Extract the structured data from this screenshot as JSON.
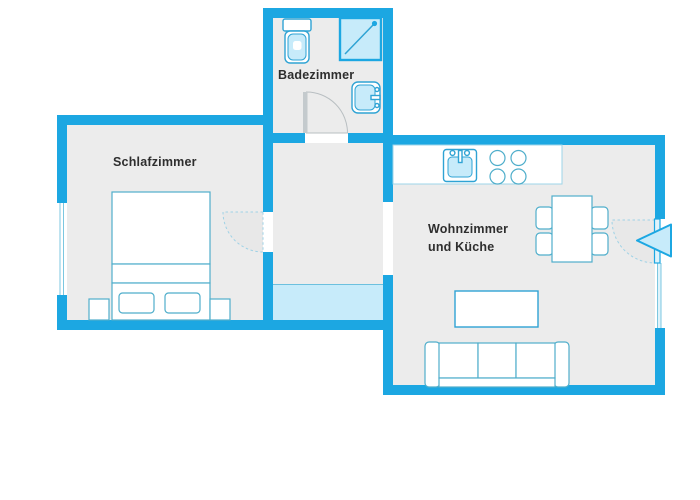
{
  "meta": {
    "type": "apartment-floor-plan",
    "language": "de"
  },
  "colors": {
    "wall": "#1CA7E2",
    "floor": "#ECECEC",
    "background": "#FFFFFF",
    "fixture_fill": "#C7EBFA",
    "fixture_stroke": "#2FA3D4",
    "furniture_stroke": "#4FAECB",
    "door_swing_fill": "#E8E8E8",
    "door_swing_edge": "#9FD2E6",
    "hallway_highlight": "#C7EBFA",
    "label_color": "#2E2E2E"
  },
  "rooms": {
    "bathroom": {
      "label": "Badezimmer",
      "fixtures": [
        "toilet",
        "shower",
        "washbasin"
      ]
    },
    "bedroom": {
      "label": "Schlafzimmer",
      "furniture": [
        "double-bed",
        "pillow",
        "pillow",
        "nightstand-left",
        "nightstand-right"
      ]
    },
    "living_kitchen": {
      "label_line1": "Wohnzimmer",
      "label_line2": "und Küche",
      "furniture": [
        "kitchen-counter",
        "kitchen-sink",
        "stove-4-burners",
        "dining-table",
        "dining-chairs-4",
        "coffee-table",
        "sofa-3-seats"
      ]
    }
  },
  "doors": {
    "count": 3,
    "entrance_marker": "left-pointing-triangle-arrow"
  },
  "windows": {
    "count": 2
  }
}
